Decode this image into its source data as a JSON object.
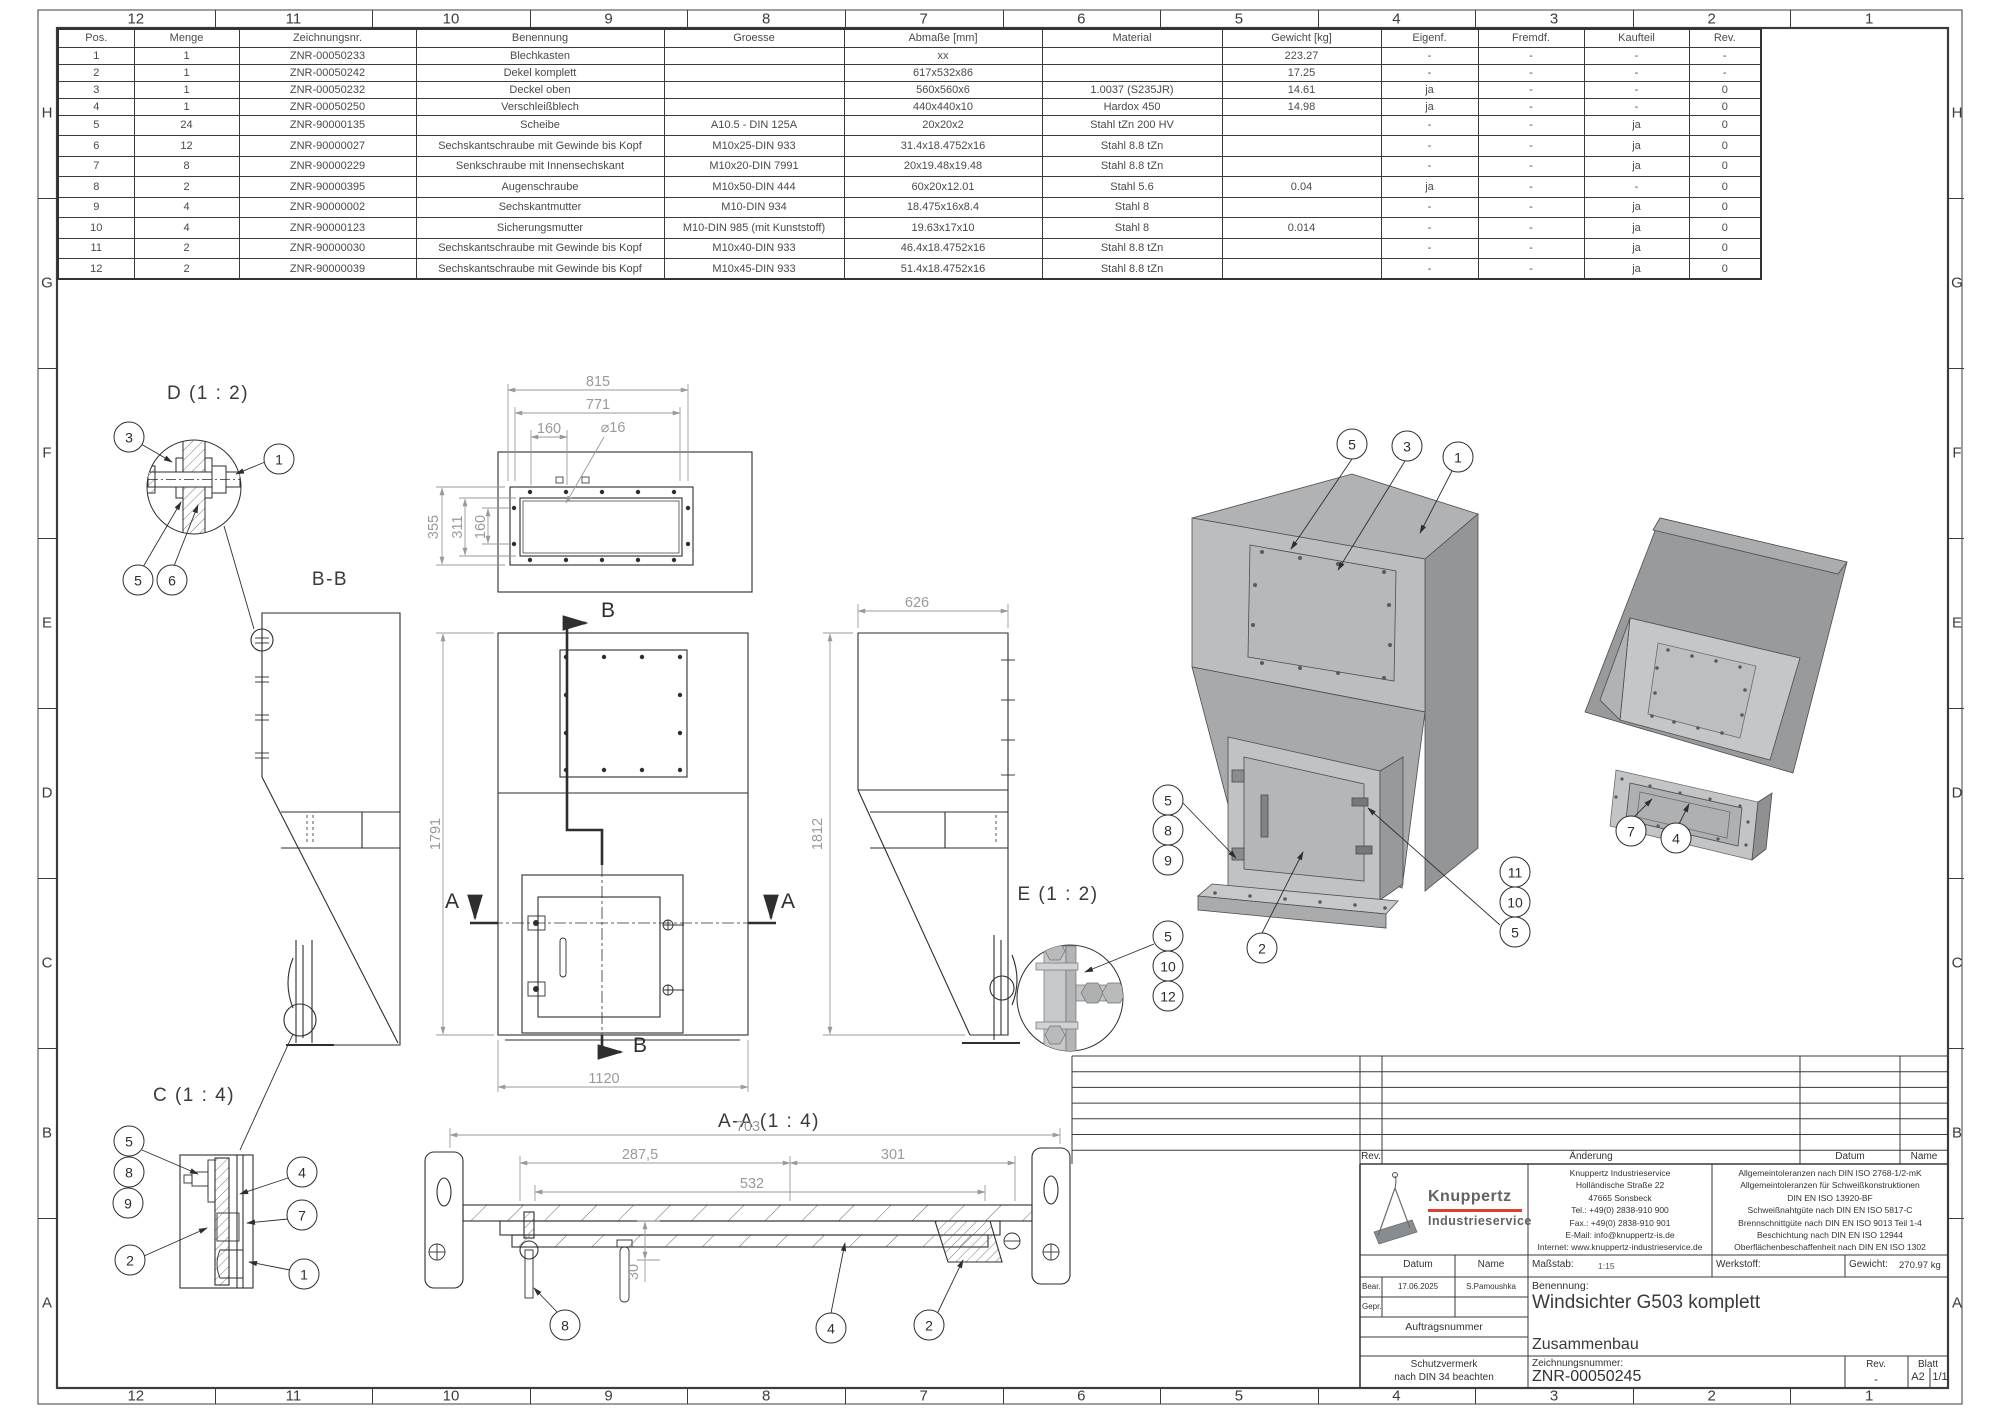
{
  "sheet": {
    "columns": [
      "12",
      "11",
      "10",
      "9",
      "8",
      "7",
      "6",
      "5",
      "4",
      "3",
      "2",
      "1"
    ],
    "rows": [
      "H",
      "G",
      "F",
      "E",
      "D",
      "C",
      "B",
      "A"
    ]
  },
  "parts_table": {
    "headers": [
      "Pos.",
      "Menge",
      "Zeichnungsnr.",
      "Benennung",
      "Groesse",
      "Abmaße [mm]",
      "Material",
      "Gewicht [kg]",
      "Eigenf.",
      "Fremdf.",
      "Kaufteil",
      "Rev."
    ],
    "rows": [
      [
        "1",
        "1",
        "ZNR-00050233",
        "Blechkasten",
        "",
        "xx",
        "",
        "223.27",
        "-",
        "-",
        "-",
        "-"
      ],
      [
        "2",
        "1",
        "ZNR-00050242",
        "Dekel komplett",
        "",
        "617x532x86",
        "",
        "17.25",
        "-",
        "-",
        "-",
        "-"
      ],
      [
        "3",
        "1",
        "ZNR-00050232",
        "Deckel oben",
        "",
        "560x560x6",
        "1.0037 (S235JR)",
        "14.61",
        "ja",
        "-",
        "-",
        "0"
      ],
      [
        "4",
        "1",
        "ZNR-00050250",
        "Verschleißblech",
        "",
        "440x440x10",
        "Hardox 450",
        "14.98",
        "ja",
        "-",
        "-",
        "0"
      ],
      [
        "5",
        "24",
        "ZNR-90000135",
        "Scheibe",
        "A10.5 - DIN 125A",
        "20x20x2",
        "Stahl tZn 200 HV",
        "",
        "-",
        "-",
        "ja",
        "0"
      ],
      [
        "6",
        "12",
        "ZNR-90000027",
        "Sechskantschraube mit Gewinde bis Kopf",
        "M10x25-DIN 933",
        "31.4x18.4752x16",
        "Stahl 8.8 tZn",
        "",
        "-",
        "-",
        "ja",
        "0"
      ],
      [
        "7",
        "8",
        "ZNR-90000229",
        "Senkschraube mit Innensechskant",
        "M10x20-DIN 7991",
        "20x19.48x19.48",
        "Stahl 8.8 tZn",
        "",
        "-",
        "-",
        "ja",
        "0"
      ],
      [
        "8",
        "2",
        "ZNR-90000395",
        "Augenschraube",
        "M10x50-DIN 444",
        "60x20x12.01",
        "Stahl 5.6",
        "0.04",
        "ja",
        "-",
        "-",
        "0"
      ],
      [
        "9",
        "4",
        "ZNR-90000002",
        "Sechskantmutter",
        "M10-DIN 934",
        "18.475x16x8.4",
        "Stahl 8",
        "",
        "-",
        "-",
        "ja",
        "0"
      ],
      [
        "10",
        "4",
        "ZNR-90000123",
        "Sicherungsmutter",
        "M10-DIN 985 (mit Kunststoff)",
        "19.63x17x10",
        "Stahl 8",
        "0.014",
        "-",
        "-",
        "ja",
        "0"
      ],
      [
        "11",
        "2",
        "ZNR-90000030",
        "Sechskantschraube mit Gewinde bis Kopf",
        "M10x40-DIN 933",
        "46.4x18.4752x16",
        "Stahl 8.8 tZn",
        "",
        "-",
        "-",
        "ja",
        "0"
      ],
      [
        "12",
        "2",
        "ZNR-90000039",
        "Sechskantschraube mit Gewinde bis Kopf",
        "M10x45-DIN 933",
        "51.4x18.4752x16",
        "Stahl 8.8 tZn",
        "",
        "-",
        "-",
        "ja",
        "0"
      ]
    ]
  },
  "views": {
    "detail_d": {
      "label": "D (1 : 2)",
      "balloons": [
        "3",
        "1",
        "5",
        "6"
      ]
    },
    "section_bb": {
      "label": "B-B"
    },
    "top_view": {
      "dims": {
        "w_outer": "815",
        "w_inner": "771",
        "w_off": "160",
        "hole": "⌀16",
        "h_outer": "355",
        "h_inner": "311",
        "h_off": "160"
      }
    },
    "front_view": {
      "dims": {
        "height": "1791",
        "width": "1120"
      },
      "cut_b": "B",
      "cut_a": "A"
    },
    "side_view": {
      "dims": {
        "depth": "626",
        "height": "1812"
      }
    },
    "section_aa": {
      "label": "A-A (1 : 4)",
      "dims": {
        "total": "703",
        "left": "287,5",
        "right": "301",
        "middle": "532",
        "drop": "30"
      },
      "balloons": [
        "8",
        "4",
        "2"
      ]
    },
    "detail_c": {
      "label": "C (1 : 4)",
      "balloons": [
        "5",
        "8",
        "9",
        "2",
        "4",
        "7",
        "1"
      ]
    },
    "detail_e": {
      "label": "E (1 : 2)",
      "balloons": [
        "5",
        "10",
        "12"
      ]
    },
    "iso_main": {
      "balloons": [
        "5",
        "3",
        "1",
        "5",
        "8",
        "9",
        "2",
        "11",
        "10",
        "5"
      ]
    },
    "iso_bottom": {
      "balloons": [
        "7",
        "4"
      ]
    }
  },
  "revision_table": {
    "headers": [
      "Rev.",
      "Änderung",
      "Datum",
      "Name"
    ]
  },
  "title_block": {
    "company": {
      "name_line1": "Knuppertz",
      "name_line2": "Industrieservice",
      "address": [
        "Knuppertz Industrieservice",
        "Holländische Straße 22",
        "47665 Sonsbeck",
        "Tel.: +49(0) 2838-910 900",
        "Fax.: +49(0) 2838-910 901",
        "E-Mail: info@knuppertz-is.de",
        "Internet: www.knuppertz-industrieservice.de"
      ]
    },
    "tolerances": [
      "Allgemeintoleranzen nach DIN ISO 2768-1/2-mK",
      "Allgemeintoleranzen für Schweißkonstruktionen",
      "DIN EN ISO 13920-BF",
      "Schweißnahtgüte nach DIN EN ISO 5817-C",
      "Brennschnittgüte nach DIN EN ISO 9013 Teil 1-4",
      "Beschichtung nach DIN EN ISO 12944",
      "Oberflächenbeschaffenheit nach DIN EN ISO 1302"
    ],
    "labels": {
      "datum": "Datum",
      "name": "Name",
      "massstab": "Maßstab:",
      "werkstoff": "Werkstoff:",
      "gewicht": "Gewicht:",
      "bear": "Bear.",
      "gepr": "Gepr.",
      "auftragsnummer": "Auftragsnummer",
      "schutzvermerk1": "Schutzvermerk",
      "schutzvermerk2": "nach DIN 34 beachten",
      "benennung": "Benennung:",
      "zeichnungsnummer": "Zeichnungsnummer:",
      "rev": "Rev.",
      "blatt": "Blatt"
    },
    "values": {
      "massstab": "1:15",
      "gewicht": "270.97 kg",
      "bear_datum": "17.06.2025",
      "bear_name": "S.Pamoushka",
      "title": "Windsichter G503 komplett",
      "subtitle": "Zusammenbau",
      "drawing_number": "ZNR-00050245",
      "rev": "-",
      "blatt_format": "A2",
      "blatt_count": "1/1"
    }
  },
  "colors": {
    "line": "#2e2e2e",
    "dim": "#9a9a9a",
    "logo_red": "#d9402f",
    "logo_gray": "#606366"
  }
}
